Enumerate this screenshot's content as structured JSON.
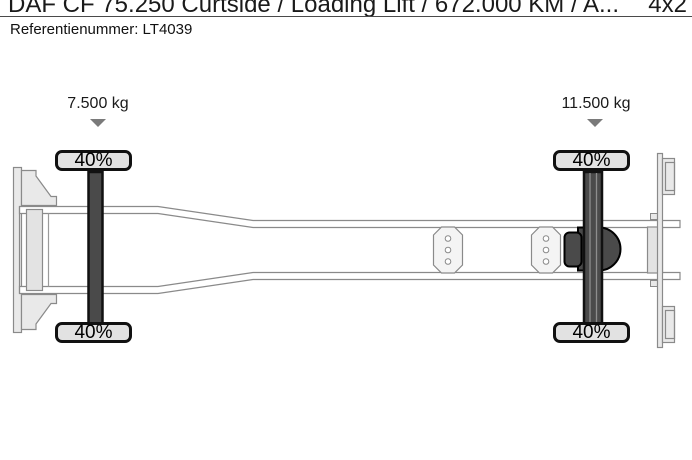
{
  "header": {
    "title": "DAF CF 75.250 Curtside / Loading Lift / 672.000 KM / A...",
    "drive_config": "4x2",
    "reference": "Referentienummer: LT4039"
  },
  "diagram": {
    "type": "truck-chassis-top-view",
    "axles": [
      {
        "name": "front",
        "load": "7.500 kg",
        "wheels": [
          "40%",
          "40%"
        ]
      },
      {
        "name": "rear",
        "load": "11.500 kg",
        "wheels": [
          "40%",
          "40%"
        ]
      }
    ],
    "colors": {
      "frame_stroke": "#8a8a8a",
      "frame_light_fill": "#e9e9e9",
      "axle_dark": "#4a4a4a",
      "wheel_fill": "#e2e2e2",
      "arrow_gray": "#7a7a7a"
    }
  }
}
